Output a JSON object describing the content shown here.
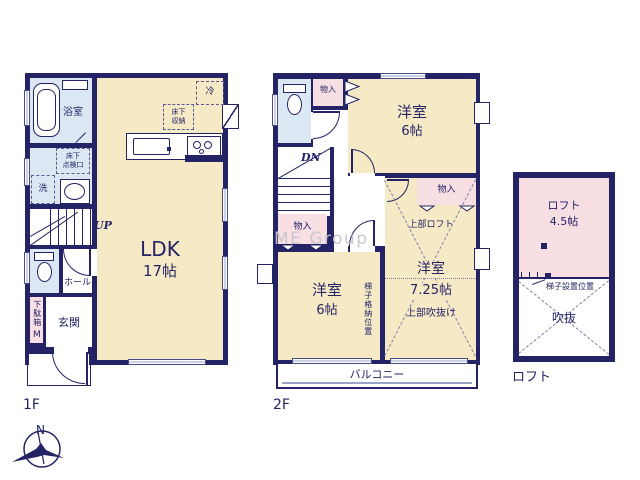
{
  "watermark": "ME Group",
  "compass_north": "N",
  "colors": {
    "wall": "#232366",
    "cream": "#f6e9c5",
    "wet": "#dbe7f3",
    "pink": "#f8dfe3",
    "text": "#232366",
    "wm": "#c6c6ce",
    "winline": "#9aa2c8"
  },
  "floor1": {
    "name": "1F",
    "bath": "浴室",
    "underfloor_access": "床下\n点検口",
    "laundry": "洗",
    "stairs_up": "UP",
    "hall": "ホール",
    "shoe_cabinet": "下駄箱",
    "shoe_cabinet_mirror": "M",
    "entrance": "玄関",
    "ldk_name": "LDK",
    "ldk_size": "17帖",
    "refrigerator": "冷",
    "underfloor_storage": "床下\n収納"
  },
  "floor2": {
    "name": "2F",
    "closet_top": "物入",
    "closet_left": "物入",
    "closet_right": "物入",
    "stairs_down": "DN",
    "bedroom_a_name": "洋室",
    "bedroom_a_size": "6帖",
    "bedroom_b_name": "洋室",
    "bedroom_b_size": "6帖",
    "bedroom_c_name": "洋室",
    "bedroom_c_size": "7.25帖",
    "upper_loft": "上部ロフト",
    "upper_void": "上部吹抜け",
    "ladder_storage": "梯子格納位置",
    "balcony": "バルコニー"
  },
  "loft": {
    "name": "ロフト",
    "area_name": "ロフト",
    "area_size": "4.5帖",
    "ladder_position": "梯子設置位置",
    "void_area": "吹抜"
  }
}
